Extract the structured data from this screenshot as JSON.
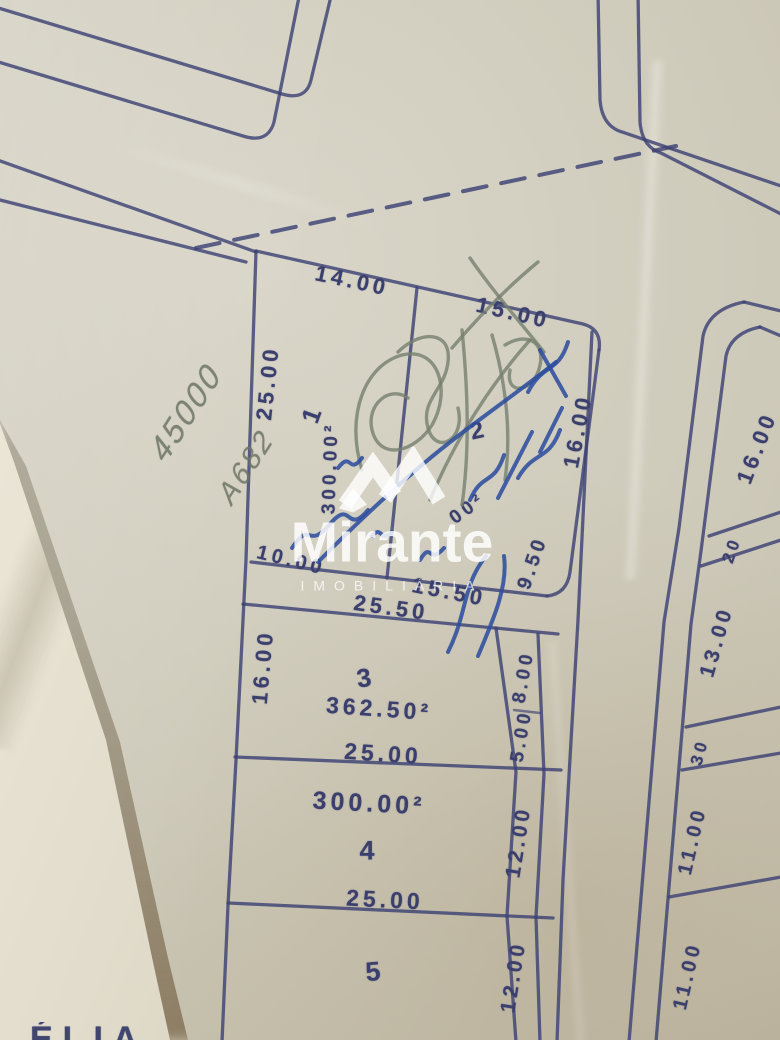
{
  "watermark": {
    "brand": "Mirante",
    "subtitle": "IMOBILIÁRIA",
    "logo": "mountain-ribbon-icon",
    "color": "#ffffff"
  },
  "plat": {
    "ink_color": "#3d4274",
    "block_a": {
      "lot_1": {
        "number": "1",
        "area": "300.00²",
        "frontage": "14.00",
        "depth_left": "25.00",
        "rear": "10.00"
      },
      "lot_2": {
        "number": "2",
        "area_partial": "00²",
        "frontage": "15.00",
        "depth_right": "16.00",
        "rear": "15.50",
        "rear_edge": "9.50"
      },
      "lot_3": {
        "number": "3",
        "area": "362.50²",
        "width_top": "25.50",
        "depth_left": "16.00",
        "width_bottom": "25.00",
        "rear_top": "8.00",
        "rear_bottom": "5.00"
      },
      "lot_4": {
        "number": "4",
        "area": "300.00²",
        "width_bottom": "25.00",
        "rear": "12.00"
      },
      "lot_5": {
        "number": "5",
        "rear": "12.00"
      }
    },
    "block_b": {
      "frontage_1": "16.00",
      "lot_a": "20",
      "frontage_2": "13.00",
      "lot_b": "30",
      "frontage_3": "11.00",
      "frontage_4": "11.00"
    },
    "street": {
      "centerline": "dashed"
    }
  },
  "annotations": {
    "pencil_price": "45000",
    "pencil_ref": "A682",
    "pencil_scribble": "green-pencil-cross-out-scrawl",
    "pen_scrawl": "illegible-blue-pen-signature-scrawl",
    "fold_clipped_text": "ÉLIA"
  }
}
